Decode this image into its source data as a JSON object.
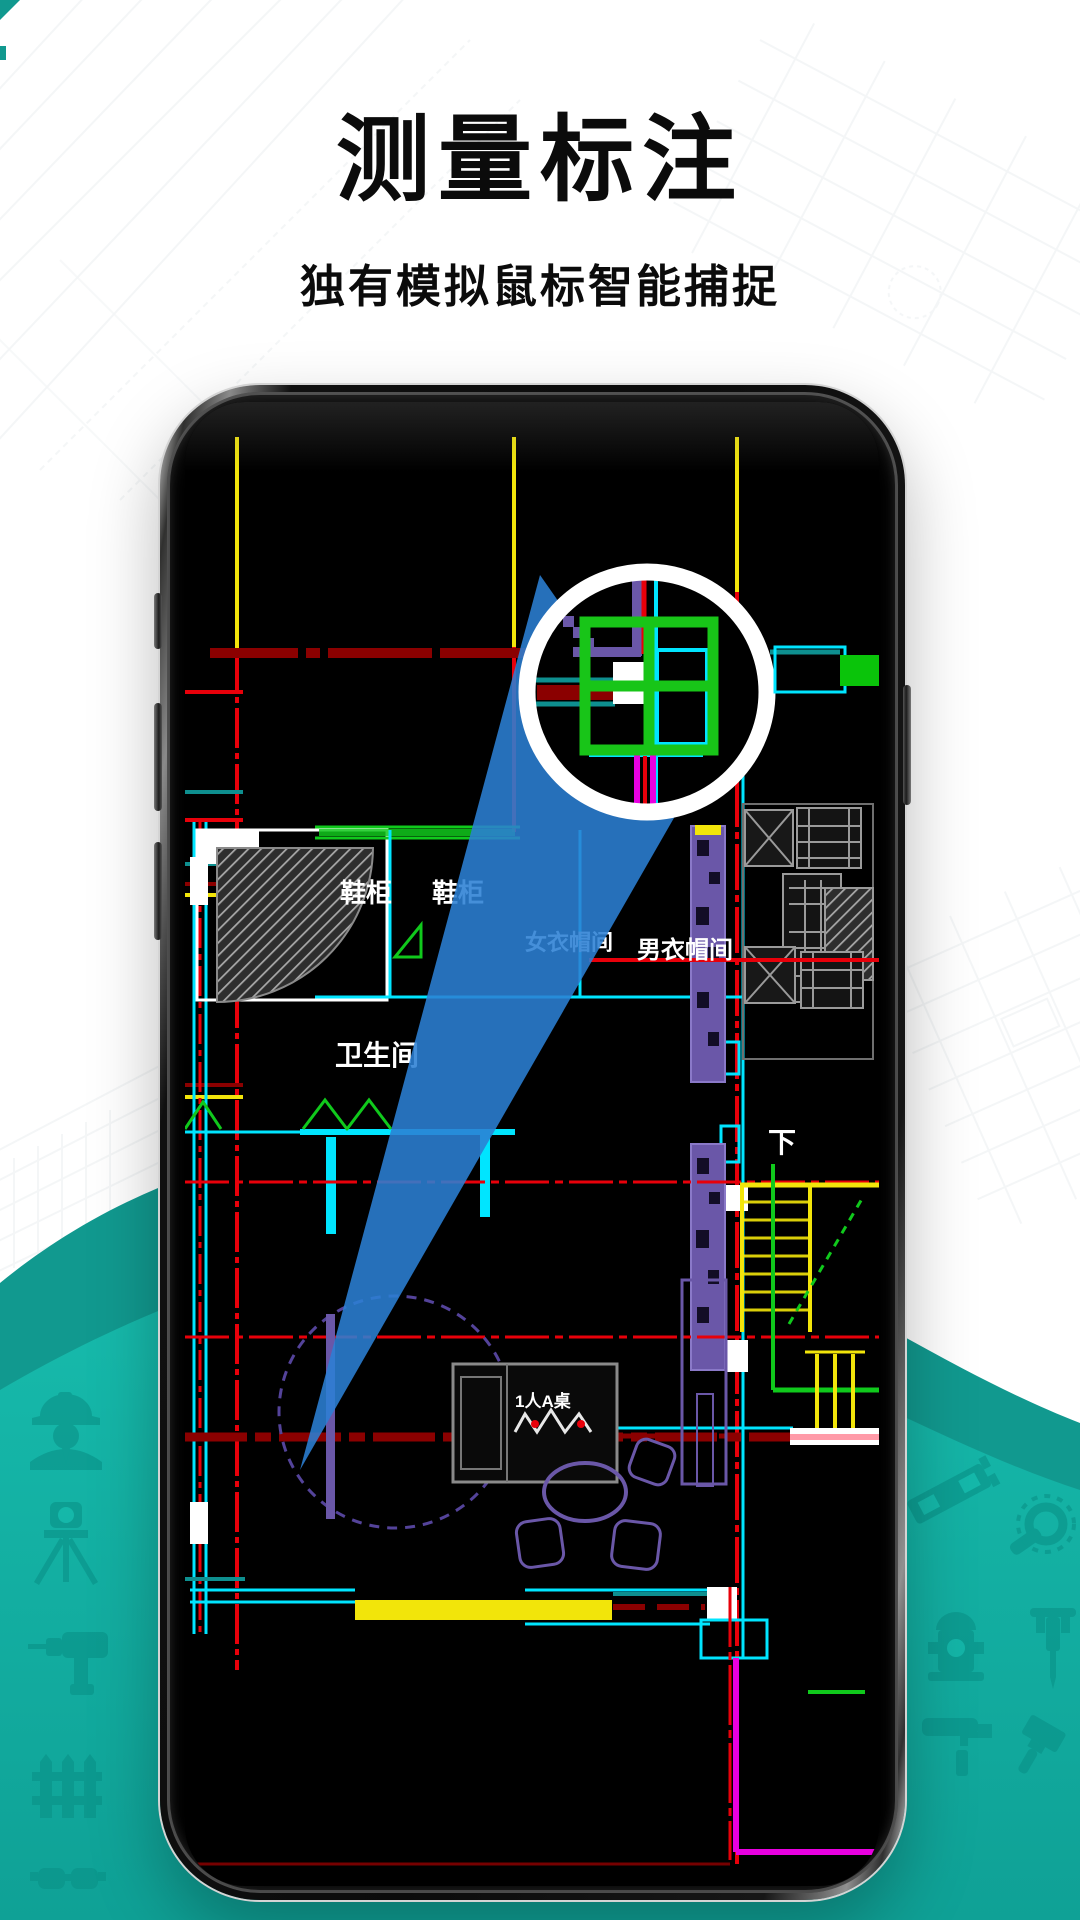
{
  "page": {
    "title": "测量标注",
    "subtitle": "独有模拟鼠标智能捕捉"
  },
  "theme": {
    "ink": "#0b0b0b",
    "teal_band": "#11998f",
    "teal_main": "#17bcad",
    "teal_deep": "#0fa196",
    "icon_teal": "#0a9288",
    "beam": "#2b80d4",
    "red": "#e8000a",
    "dimred": "#8b0000",
    "cyan": "#00e5ff",
    "tealline": "#0e8f8f",
    "green": "#10c91c",
    "gridgreen": "#18c518",
    "yellow": "#f2e50a",
    "magenta": "#e800e0",
    "purple": "#6a57a8",
    "purpledark": "#54439a",
    "grayblock": "#9a9a9a",
    "sketch": "#8fa3ad"
  },
  "cad_labels": {
    "entry_cabinet_1": "鞋柜",
    "entry_cabinet_2": "鞋柜",
    "bathroom": "卫生间",
    "closet_female": "女衣帽间",
    "closet_male": "男衣帽间",
    "stairs_down": "下",
    "dining_table": "1人A桌"
  },
  "decor_icons": [
    "worker-icon",
    "tripod-icon",
    "drill-icon",
    "fence-icon",
    "goggles-icon",
    "level-icon",
    "magnifier-wrench-icon",
    "hydrant-icon",
    "jackhammer-icon",
    "paint-roller-icon",
    "brush-icon"
  ]
}
